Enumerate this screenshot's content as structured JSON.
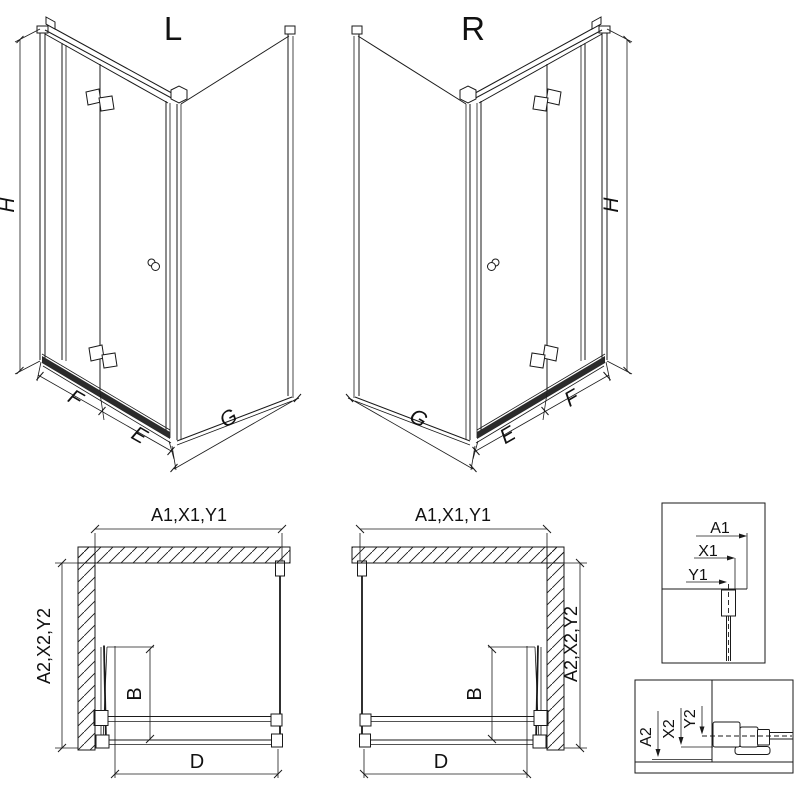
{
  "iso_left": {
    "label": "L",
    "h": "H",
    "f": "F",
    "e": "E",
    "g": "G"
  },
  "iso_right": {
    "label": "R",
    "h": "H",
    "f": "F",
    "e": "E",
    "g": "G"
  },
  "plan_left": {
    "top": "A1,X1,Y1",
    "side": "A2,X2,Y2",
    "b": "B",
    "d": "D"
  },
  "plan_right": {
    "top": "A1,X1,Y1",
    "side": "A2,X2,Y2",
    "b": "B",
    "d": "D"
  },
  "detail_top": {
    "a": "A1",
    "x": "X1",
    "y": "Y1"
  },
  "detail_bottom": {
    "a": "A2",
    "x": "X2",
    "y": "Y2"
  },
  "colors": {
    "line": "#1a1a1a",
    "band": "#2b2b2b",
    "background": "#ffffff"
  }
}
